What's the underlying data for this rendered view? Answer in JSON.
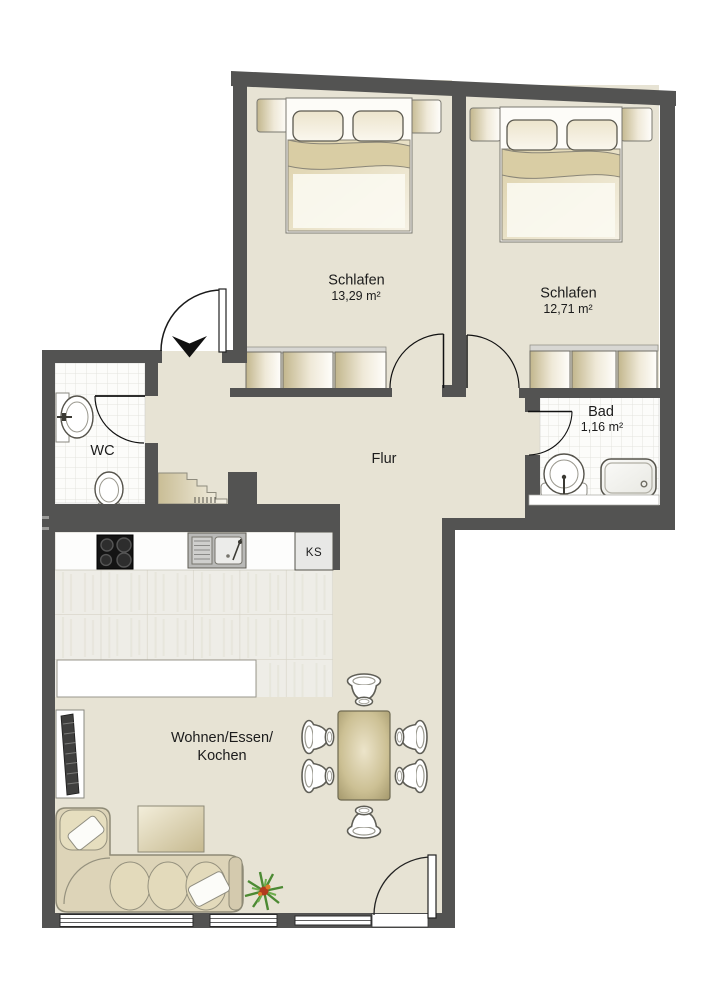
{
  "rooms": {
    "schlafen1": {
      "name": "Schlafen",
      "area": "13,29 m²"
    },
    "schlafen2": {
      "name": "Schlafen",
      "area": "12,71 m²"
    },
    "wc": {
      "name": "WC"
    },
    "bad": {
      "name": "Bad",
      "area": "1,16 m²"
    },
    "flur": {
      "name": "Flur"
    },
    "wohnen": {
      "line1": "Wohnen/Essen/",
      "line2": "Kochen"
    }
  },
  "kitchen": {
    "fridge": "KS"
  },
  "colors": {
    "wall": "#535352",
    "floor_beige": "#e7e3d4",
    "tile_white": "#fcfcfa",
    "wood_tile": "#eeede7",
    "furniture_cream": "#ddd4b8",
    "ink": "#1c1c1c"
  }
}
